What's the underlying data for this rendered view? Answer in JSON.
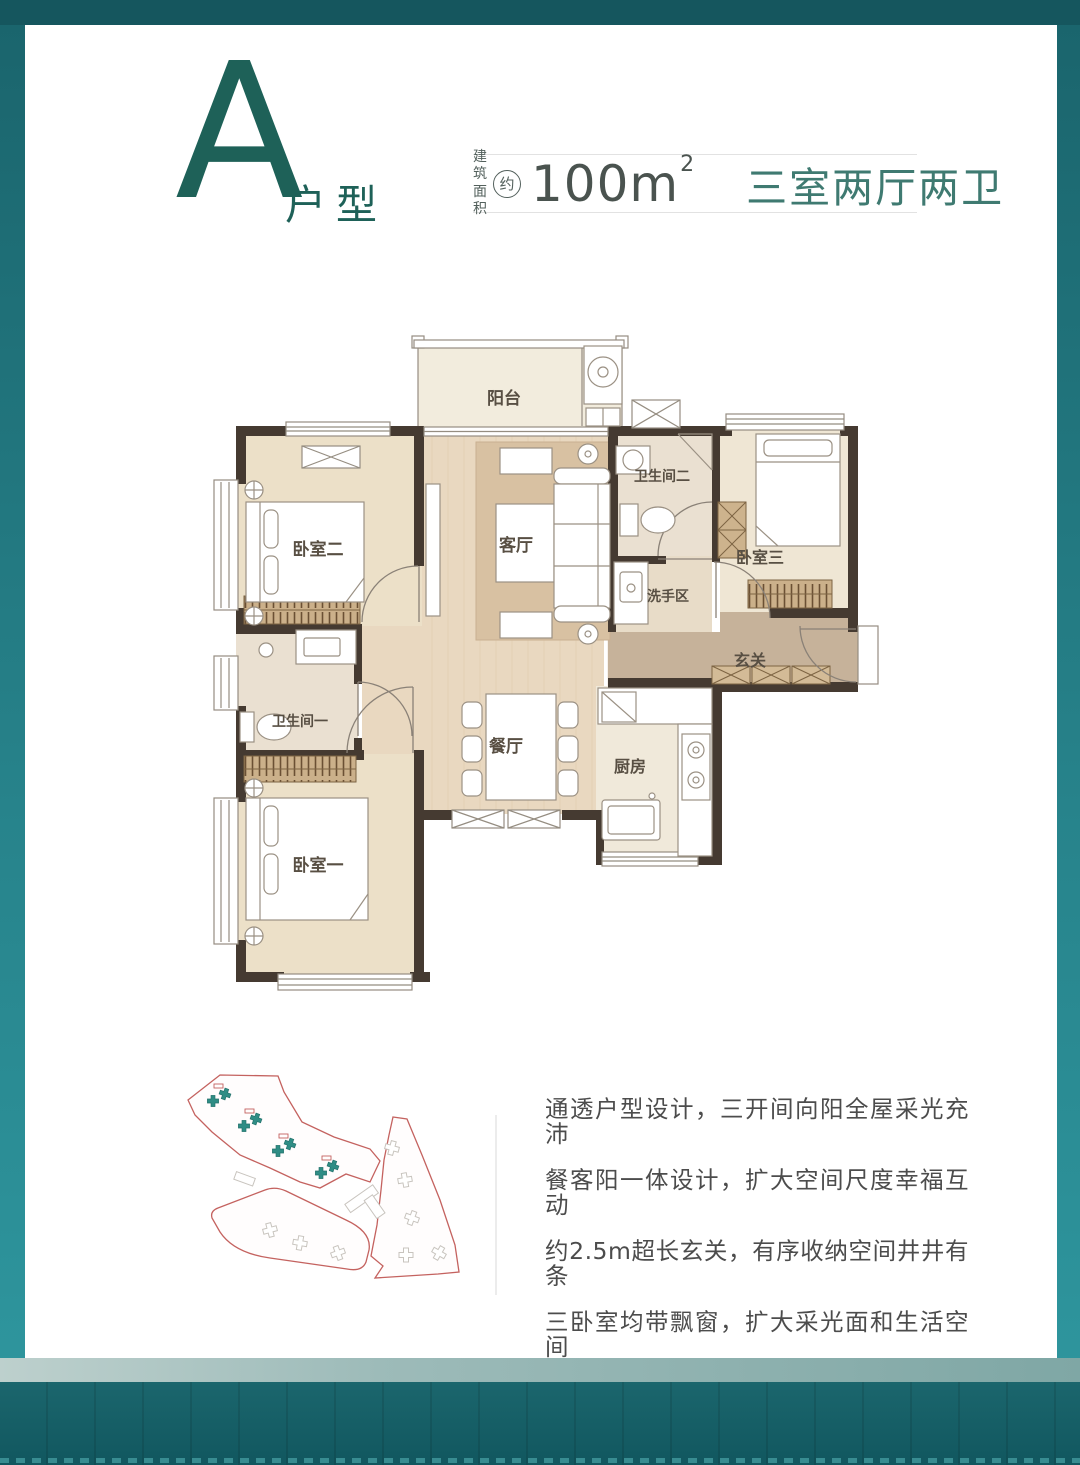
{
  "header": {
    "unit_letter": "A",
    "unit_suffix": "户型",
    "area_label_line1": "建筑",
    "area_label_line2": "面积",
    "area_approx": "约",
    "area_value": "100m",
    "area_superscript": "2",
    "rooms_summary": "三室两厅两卫"
  },
  "colors": {
    "accent_dark_teal": "#1e6158",
    "rooms_summary_teal": "#3f7a71",
    "frame_teal": "#2f98a0",
    "site_outline_red": "#c4625f",
    "site_building_teal": "#2f8d85"
  },
  "floorplan": {
    "balcony": "阳台",
    "bedroom2": "卧室二",
    "living": "客厅",
    "bath2": "卫生间二",
    "bedroom3": "卧室三",
    "wash_area": "洗手区",
    "foyer": "玄关",
    "bath1": "卫生间一",
    "dining": "餐厅",
    "kitchen": "厨房",
    "bedroom1": "卧室一"
  },
  "description": {
    "lines": [
      "通透户型设计，三开间向阳全屋采光充沛",
      "餐客阳一体设计，扩大空间尺度幸福互动",
      "约2.5m超长玄关，有序收纳空间井井有条",
      "三卧室均带飘窗，扩大采光面和生活空间",
      "明厨明卫，干湿分离，科学设计尽享舒居"
    ]
  }
}
